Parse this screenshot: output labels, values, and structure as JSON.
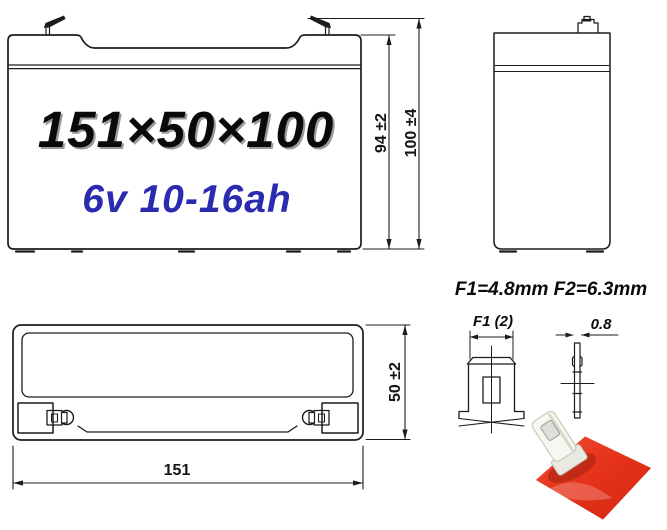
{
  "colors": {
    "line": "#1c1c1c",
    "label_blue": "#2b2bb0",
    "terminal_red": "#e0341b"
  },
  "front_view": {
    "size_text": "151×50×100",
    "spec_text": "6v 10-16ah"
  },
  "dims": {
    "inner_height": "94 ±2",
    "total_height": "100 ±4",
    "depth": "50 ±2",
    "width": "151"
  },
  "terminal": {
    "title": "F1=4.8mm F2=6.3mm",
    "front_label": "F1 (2)",
    "thickness": "0.8"
  }
}
